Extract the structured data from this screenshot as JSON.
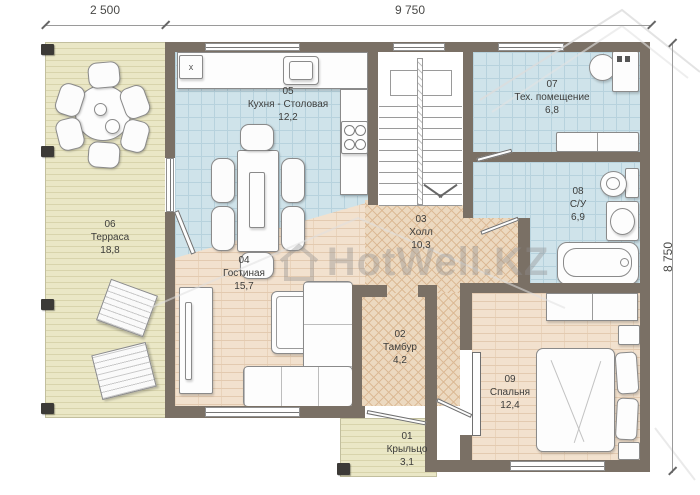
{
  "watermark": {
    "text": "HotWell.KZ"
  },
  "dims": {
    "top_left": "2 500",
    "top_main": "9 750",
    "right": "8 750"
  },
  "rooms": [
    {
      "number": "01",
      "name": "Крыльцо",
      "area": "3,1"
    },
    {
      "number": "02",
      "name": "Тамбур",
      "area": "4,2"
    },
    {
      "number": "03",
      "name": "Холл",
      "area": "10,3"
    },
    {
      "number": "04",
      "name": "Гостиная",
      "area": "15,7"
    },
    {
      "number": "05",
      "name": "Кухня - Столовая",
      "area": "12,2"
    },
    {
      "number": "06",
      "name": "Терраса",
      "area": "18,8"
    },
    {
      "number": "07",
      "name": "Тех. помещение",
      "area": "6,8"
    },
    {
      "number": "08",
      "name": "С/У",
      "area": "6,9"
    },
    {
      "number": "09",
      "name": "Спальня",
      "area": "12,4"
    }
  ],
  "fixtures": {
    "kitchen_box": "x"
  },
  "colors": {
    "wall": "#7a7065",
    "kitchen_tile": "#cfe3ea",
    "brick_floor": "#f2e1ce",
    "herringbone_floor": "#ecd9c0",
    "terrace_floor": "#eae7c6",
    "label_text": "#3d3d3b",
    "watermark_gray": "#8f8f8f"
  }
}
